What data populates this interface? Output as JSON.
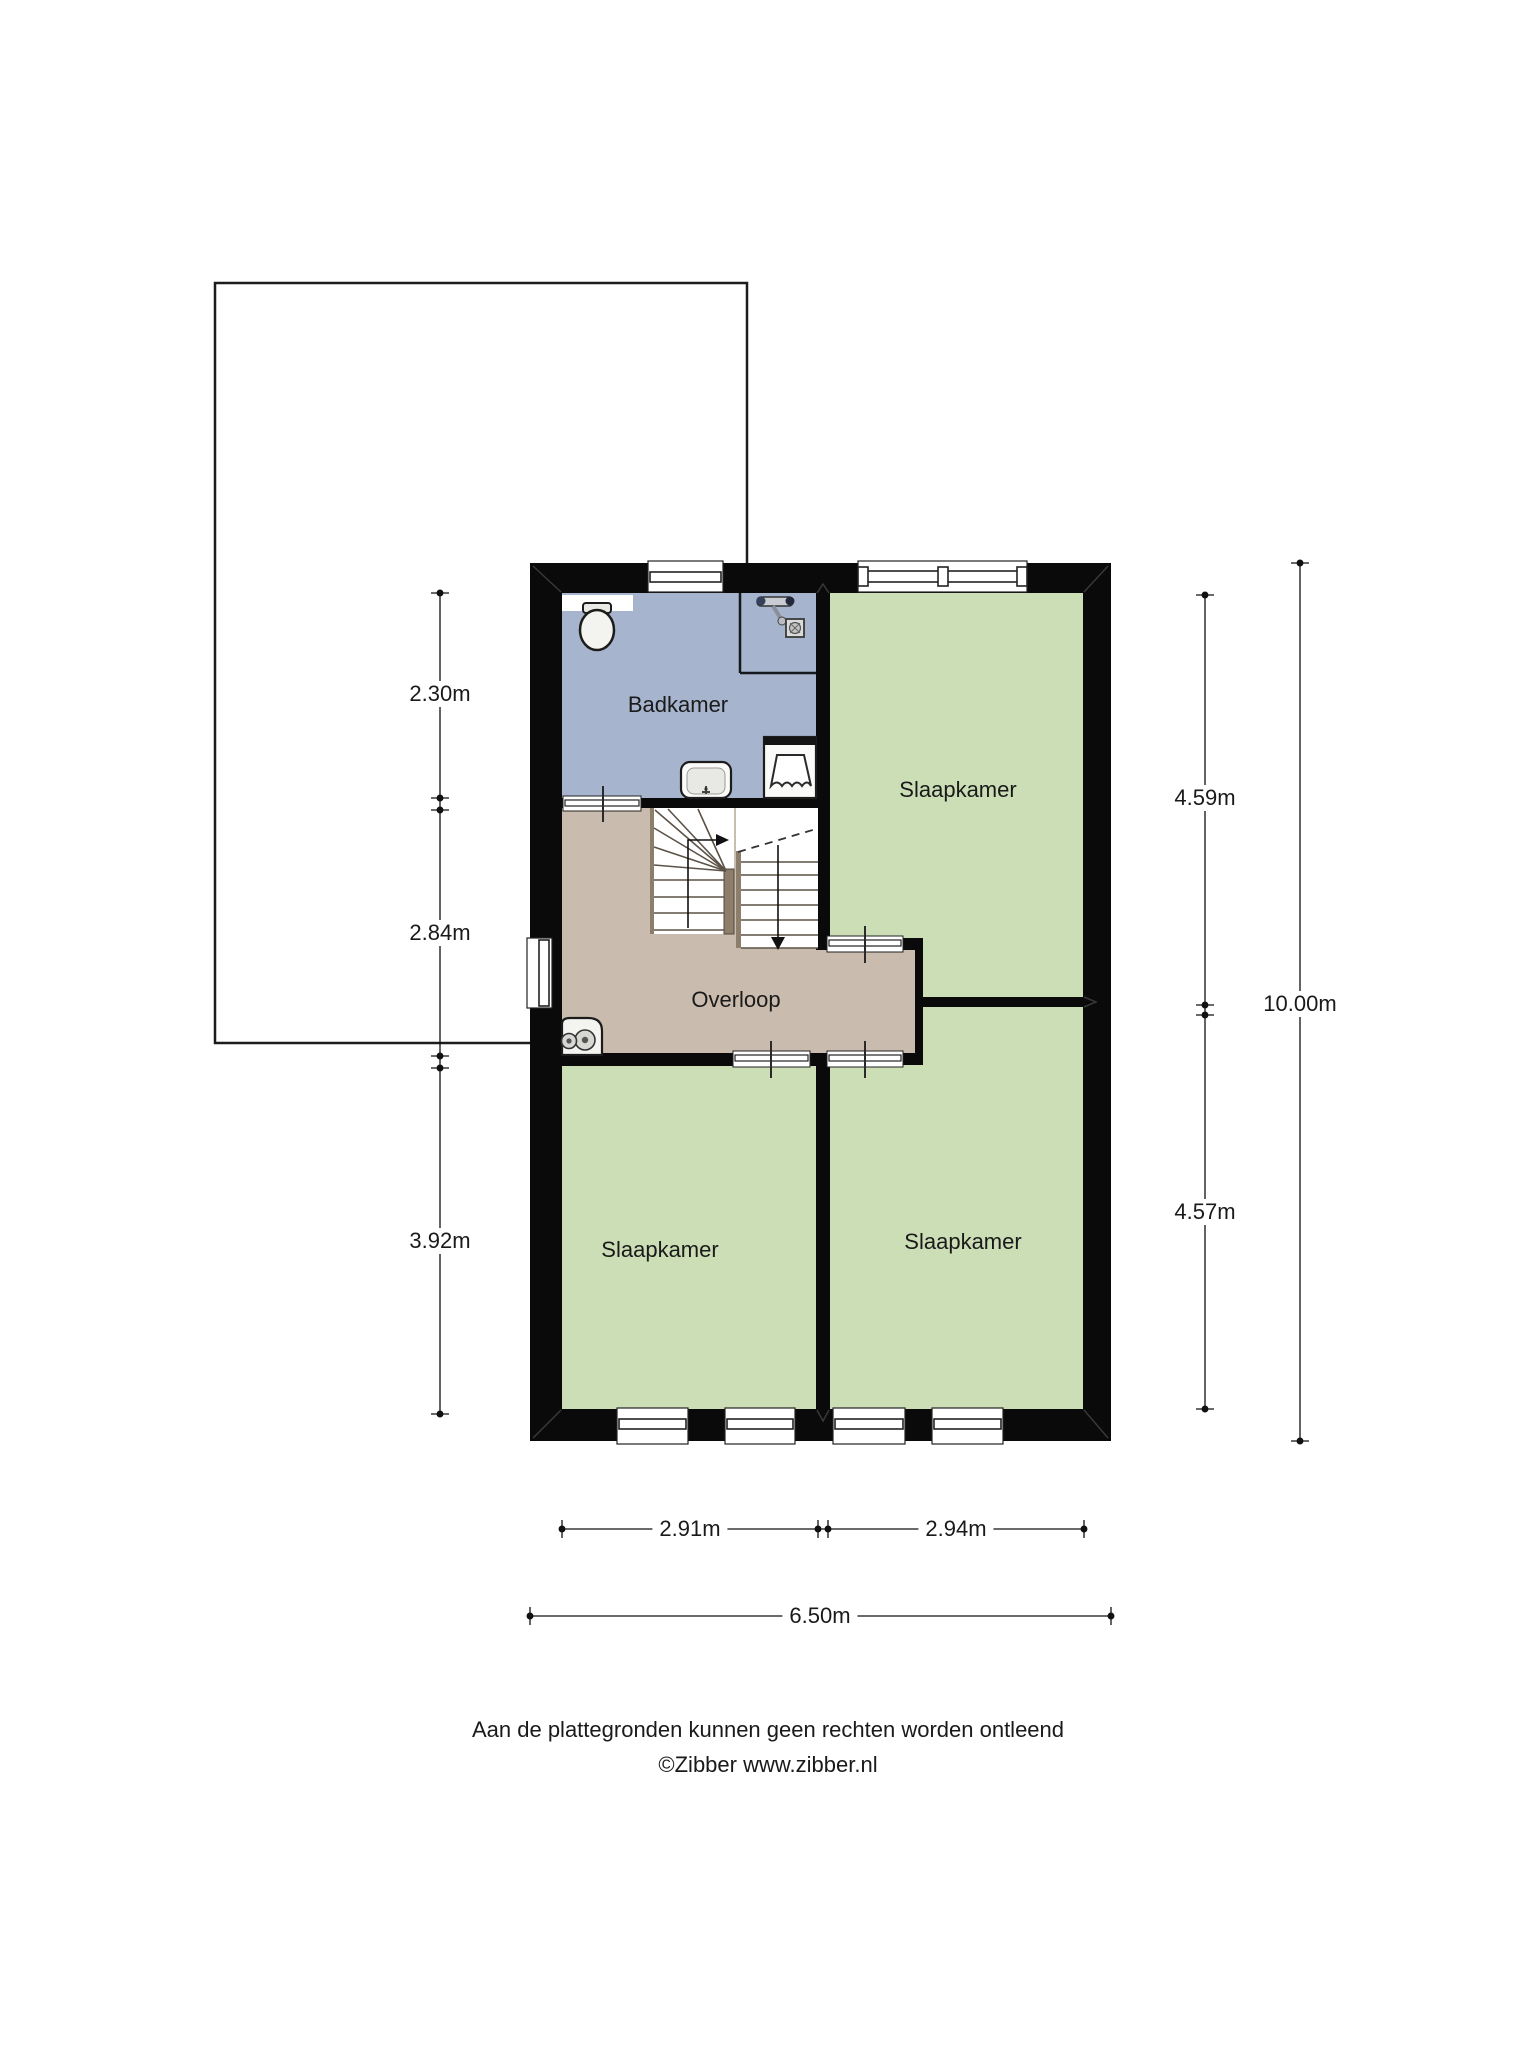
{
  "floor_plan": {
    "wall_color": "#0a0a0a",
    "rooms": {
      "badkamer": {
        "label": "Badkamer",
        "color": "#a6b5cd"
      },
      "slaapkamer_top_right": {
        "label": "Slaapkamer",
        "color": "#cbdeb6"
      },
      "slaapkamer_bottom_left": {
        "label": "Slaapkamer",
        "color": "#cbdeb6"
      },
      "slaapkamer_bottom_right": {
        "label": "Slaapkamer",
        "color": "#cbdeb6"
      },
      "overloop": {
        "label": "Overloop",
        "color": "#c9bcae"
      }
    },
    "fixtures": [
      "toilet",
      "shower-mixer",
      "shower-drain",
      "washbasin",
      "washing-machine",
      "ventilation-unit",
      "staircase"
    ],
    "stair_wood_color": "#8d7d6b"
  },
  "dimensions": {
    "left": [
      {
        "value": "2.30m"
      },
      {
        "value": "2.84m"
      },
      {
        "value": "3.92m"
      }
    ],
    "right": [
      {
        "value": "4.59m"
      },
      {
        "value": "4.57m"
      }
    ],
    "right_total": {
      "value": "10.00m"
    },
    "bottom": [
      {
        "value": "2.91m"
      },
      {
        "value": "2.94m"
      }
    ],
    "bottom_total": {
      "value": "6.50m"
    }
  },
  "footer": {
    "disclaimer": "Aan de plattegronden kunnen geen rechten worden ontleend",
    "copyright": "©Zibber www.zibber.nl"
  }
}
